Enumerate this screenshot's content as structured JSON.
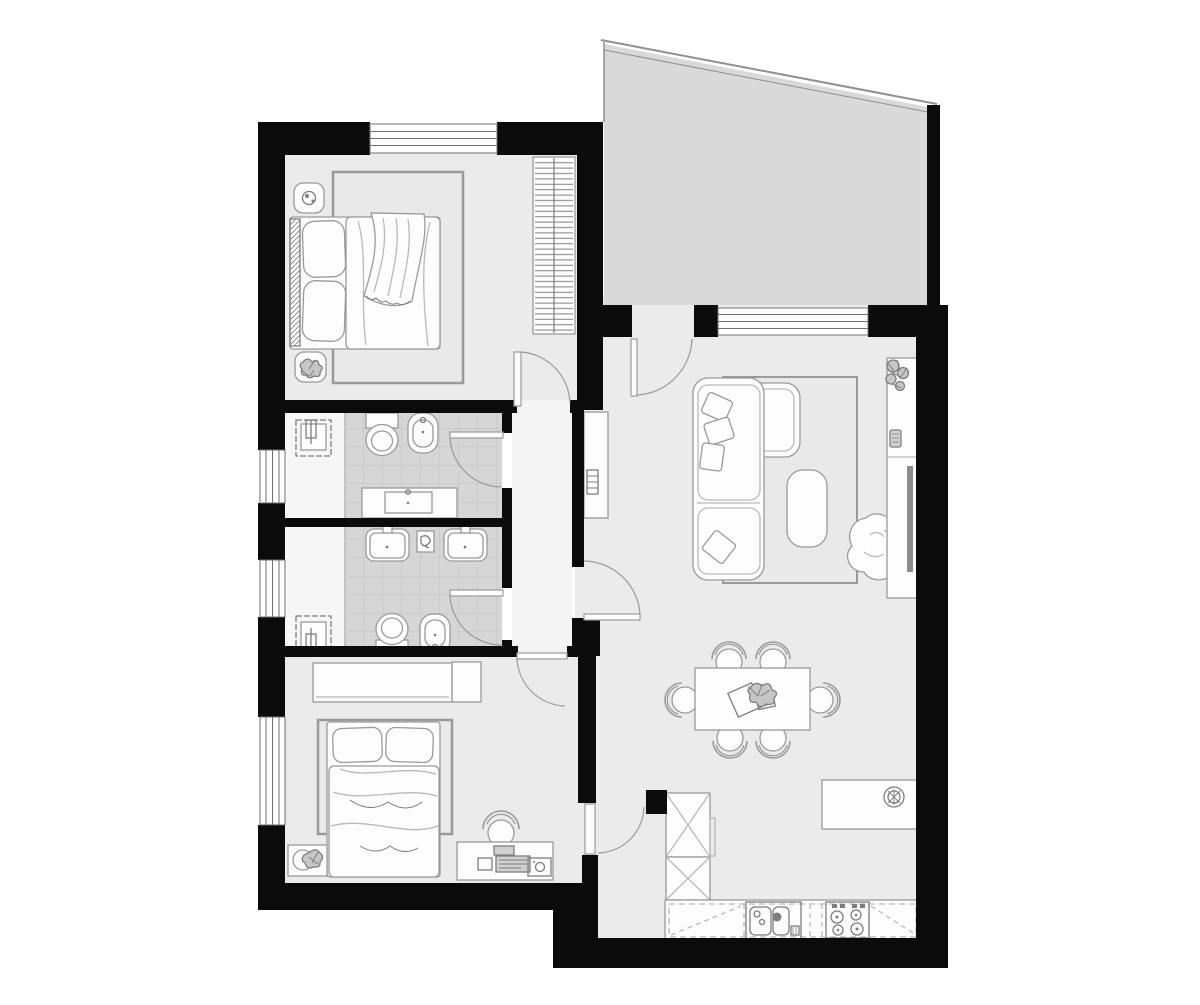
{
  "app": {
    "type": "architectural-floor-plan",
    "title": "Two-bedroom apartment floor plan, top view",
    "canvas_px": {
      "width": 1200,
      "height": 1005
    }
  },
  "colors": {
    "white": "#ffffff",
    "wall": "#0b0b0b",
    "floor": "#ebebec",
    "hall_floor": "#f4f4f5",
    "bath_strip": "#f7f7f8",
    "tile": "#d6d6d7",
    "tile_grid": "#c3c3c4",
    "balcony": "#d9d9d9",
    "balcony_edge": "#8f8f8f",
    "furniture_fill": "#fdfdfd",
    "furniture_stroke": "#9a9a9a",
    "detail_stroke": "#7d7d7d",
    "soft_stroke": "#b9b9ba",
    "rug_fill": "#e9e9ea",
    "window_line": "#6f6f6f",
    "tv_fill": "#8c8c8c",
    "headboard_fill": "#b8b8b9",
    "appliance_fill": "#d0d0d1",
    "plant_fill": "#c6c6c7"
  },
  "rooms": {
    "bedroom1": {
      "name": "Bedroom 1",
      "items": [
        "double bed",
        "upholstered headboard",
        "two pillows",
        "duvet with throw blanket",
        "area rug",
        "nightstand with lamp",
        "nightstand with plant",
        "radiator",
        "window"
      ]
    },
    "bathroom1": {
      "name": "Bathroom 1",
      "items": [
        "toilet",
        "bidet",
        "vanity washbasin",
        "water heater box",
        "tiled floor",
        "swing door"
      ]
    },
    "bathroom2": {
      "name": "Bathroom 2 / Laundry",
      "items": [
        "twin washbasins",
        "shelf box",
        "toilet",
        "bidet",
        "water heater box",
        "tiled floor",
        "swing door"
      ]
    },
    "hallway": {
      "name": "Hallway",
      "items": [
        "doors to all rooms"
      ]
    },
    "bedroom2": {
      "name": "Bedroom 2",
      "items": [
        "wardrobe",
        "double bed",
        "two pillows",
        "area rug",
        "desk with computer and printer",
        "office chair",
        "basket with plant",
        "window"
      ]
    },
    "living": {
      "name": "Living / Dining room",
      "items": [
        "corner sofa with cushions",
        "ottoman coffee table",
        "area rug",
        "lounge beanbag",
        "TV sideboard",
        "potted plant",
        "console table",
        "dining table for six",
        "six chairs",
        "table centerpiece"
      ]
    },
    "kitchen": {
      "name": "Kitchen",
      "items": [
        "two tall cabinets",
        "base counter with dashed upper cabinets",
        "double-bowl sink with faucet",
        "four-burner cooktop",
        "island with bowl"
      ]
    },
    "balcony": {
      "name": "Balcony",
      "items": [
        "open terrace, sloped parapet"
      ]
    }
  },
  "openings": {
    "doors": [
      {
        "id": "bedroom1-door",
        "swing": "into bedroom 1"
      },
      {
        "id": "bathroom1-door",
        "swing": "into bathroom 1"
      },
      {
        "id": "bathroom2-door",
        "swing": "into bathroom 2"
      },
      {
        "id": "bedroom2-door",
        "swing": "into bedroom 2"
      },
      {
        "id": "living-door",
        "swing": "into living room"
      },
      {
        "id": "kitchen-door",
        "swing": "into kitchen"
      },
      {
        "id": "balcony-door",
        "swing": "into living room"
      }
    ],
    "windows": [
      {
        "id": "bedroom1-window",
        "wall": "top"
      },
      {
        "id": "bathroom1-window",
        "wall": "left"
      },
      {
        "id": "bathroom2-window",
        "wall": "left"
      },
      {
        "id": "bedroom2-window",
        "wall": "left"
      },
      {
        "id": "living-window",
        "wall": "top"
      }
    ]
  }
}
